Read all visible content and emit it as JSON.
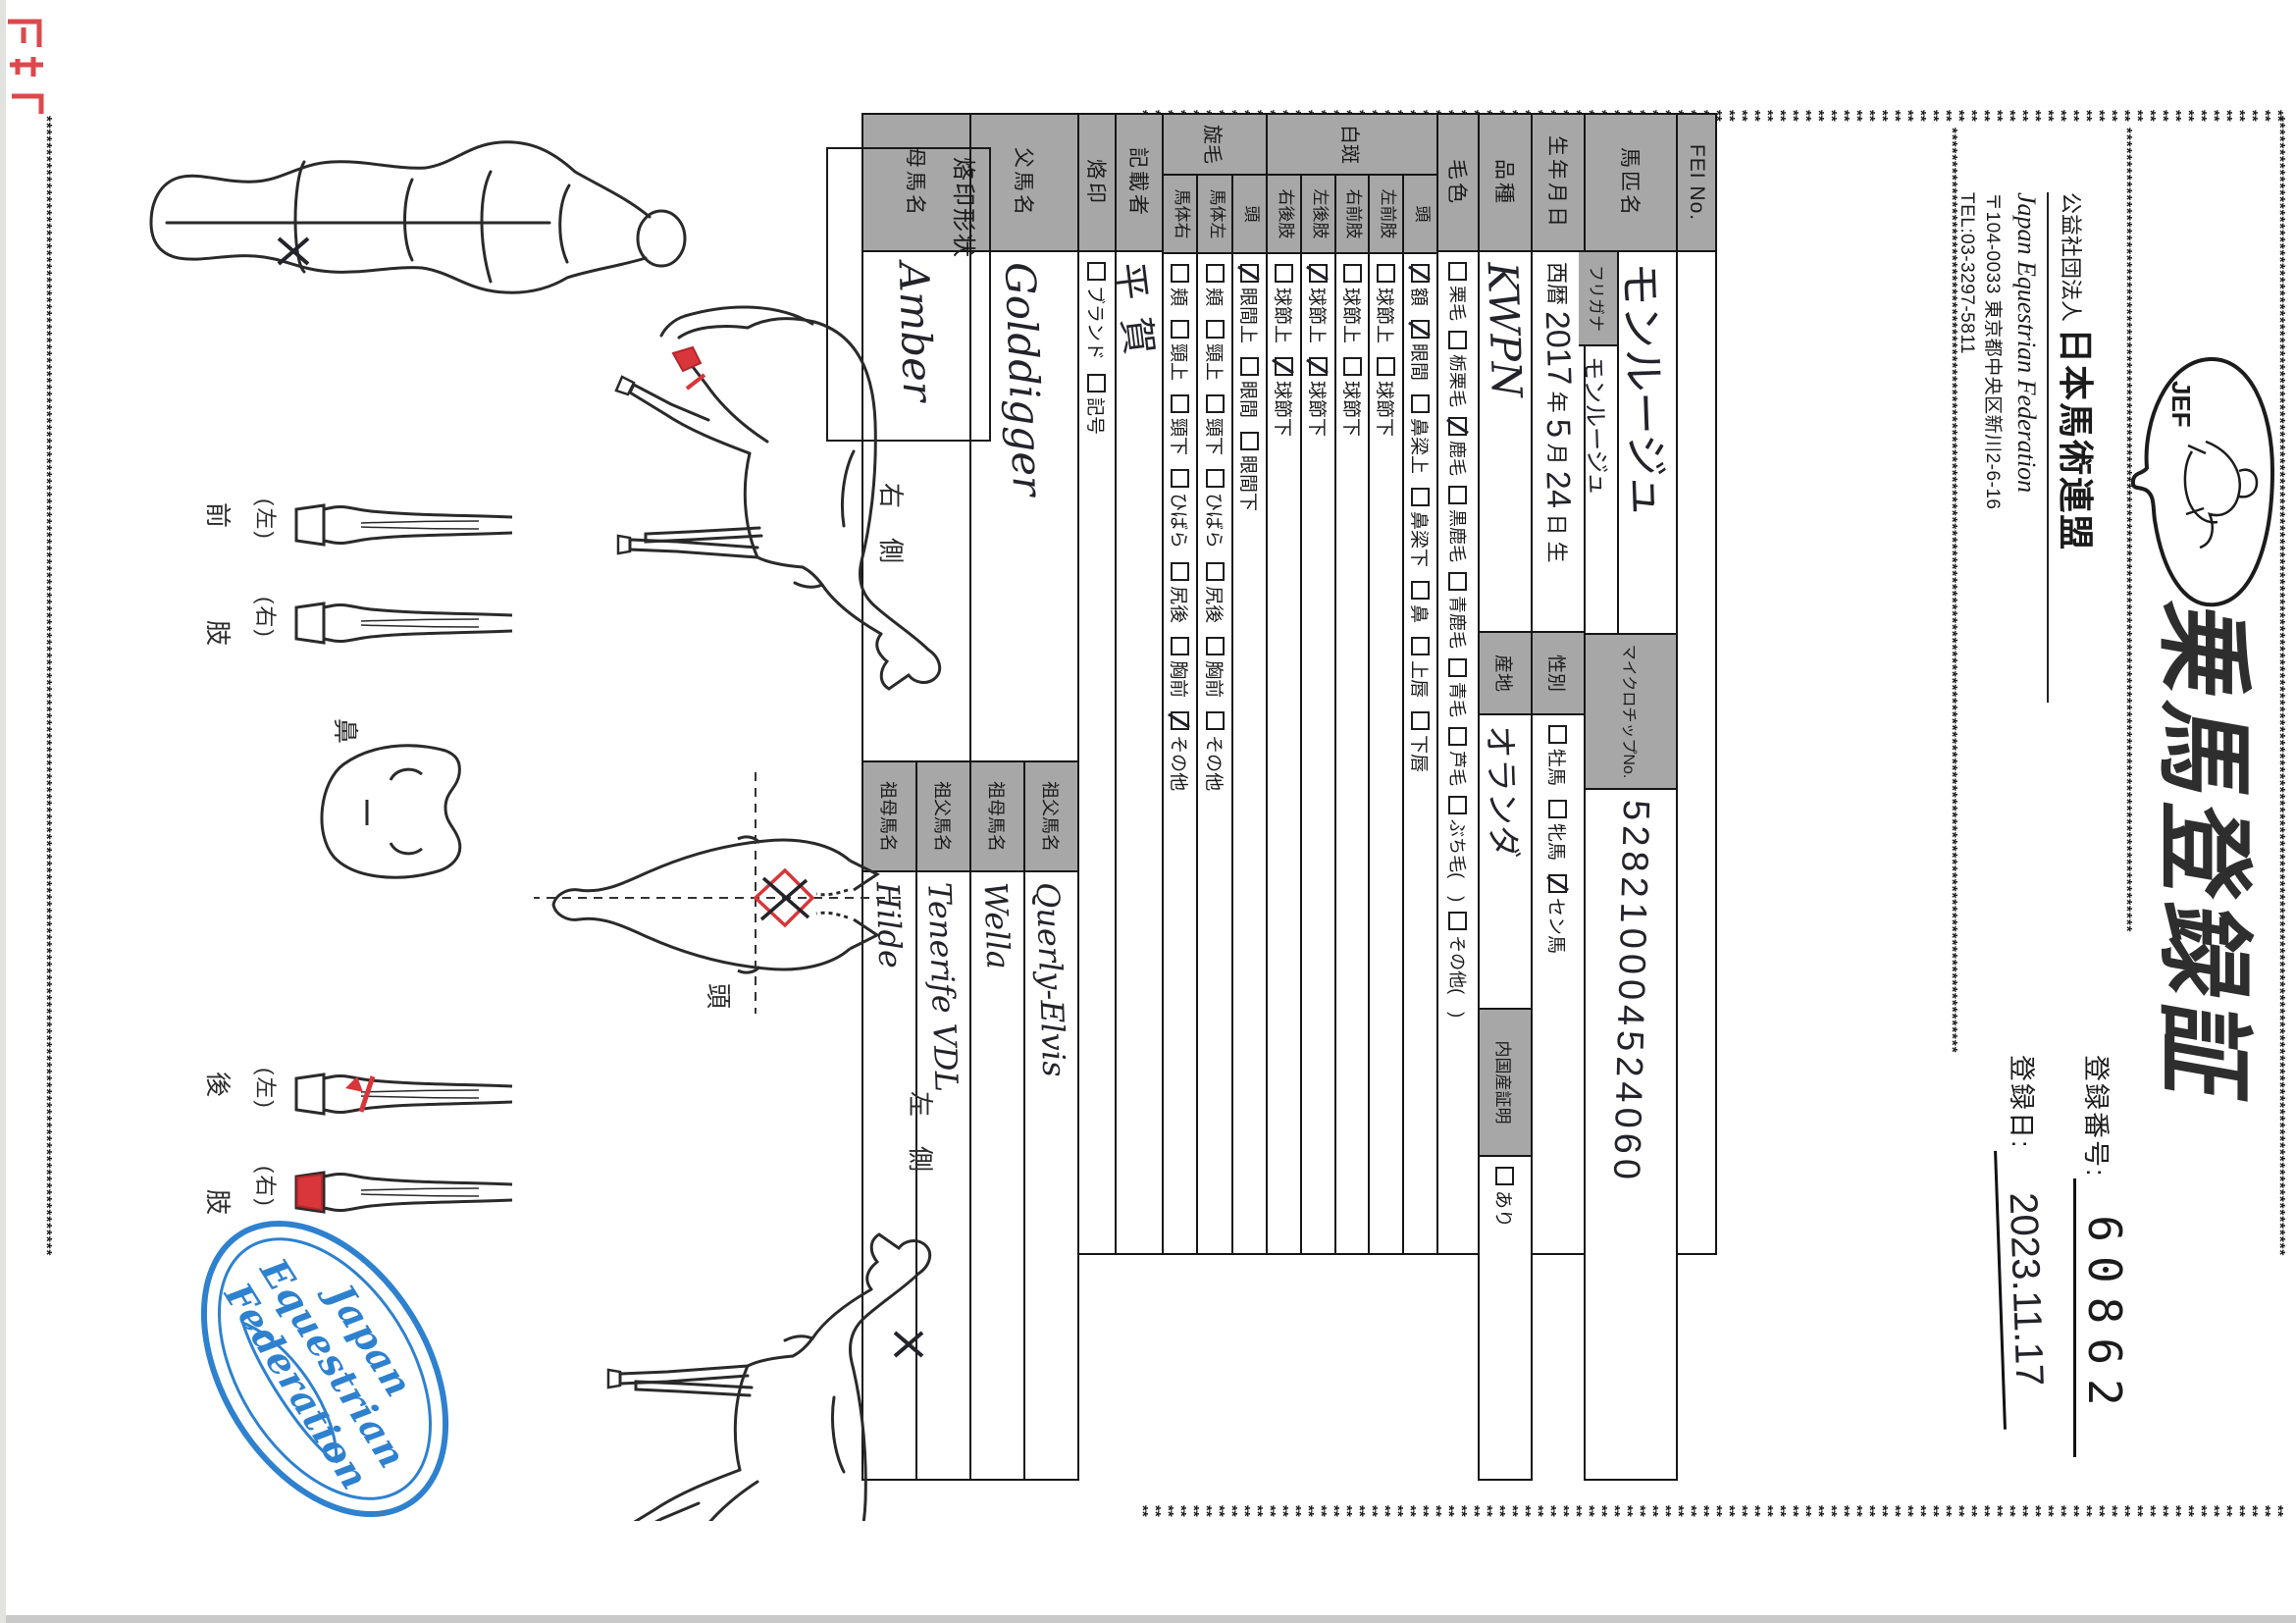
{
  "decor": {
    "star": "*",
    "ink": "#1b1b1b",
    "gray_cell": "#a7a7a7",
    "red": "#d8363a",
    "blue": "#2e81cf"
  },
  "header": {
    "logo_text": "JEF",
    "org_prefix": "公益社団法人",
    "org_name": "日本馬術連盟",
    "org_name_en": "Japan Equestrian Federation",
    "address": "〒104-0033 東京都中央区新川2-6-16",
    "tel": "TEL:03-3297-5811",
    "title": "乗馬登録証",
    "reg_no_label": "登録番号:",
    "reg_no": "60862",
    "reg_date_label": "登録日:",
    "reg_date": "2023.11.17"
  },
  "table": {
    "fei": {
      "label": "FEI No.",
      "value": ""
    },
    "name": {
      "label": "馬匹名",
      "value": "モンルージュ"
    },
    "furigana": {
      "label": "フリガナ",
      "value": "モンルージュ"
    },
    "microchip": {
      "label": "マイクロチップNo.",
      "value": "528210004524060"
    },
    "birth": {
      "label": "生年月日",
      "era": "西暦",
      "year": "2017",
      "year_suffix": "年",
      "month": "5",
      "month_suffix": "月",
      "day": "24",
      "day_suffix": "日 生"
    },
    "sex": {
      "label": "性別",
      "options": [
        {
          "label": "牡馬",
          "checked": false
        },
        {
          "label": "牝馬",
          "checked": false
        },
        {
          "label": "セン馬",
          "checked": true
        }
      ]
    },
    "breed": {
      "label": "品種",
      "value": "KWPN"
    },
    "origin": {
      "label": "産地",
      "value": "オランダ"
    },
    "domestic": {
      "label": "内国産証明",
      "options": [
        {
          "label": "あり",
          "checked": false
        }
      ]
    },
    "coat": {
      "label": "毛色",
      "options": [
        {
          "label": "栗毛",
          "checked": false
        },
        {
          "label": "栃栗毛",
          "checked": false
        },
        {
          "label": "鹿毛",
          "checked": true
        },
        {
          "label": "黒鹿毛",
          "checked": false
        },
        {
          "label": "青鹿毛",
          "checked": false
        },
        {
          "label": "青毛",
          "checked": false
        },
        {
          "label": "芦毛",
          "checked": false
        },
        {
          "label": "ぶち毛(　)",
          "checked": false
        },
        {
          "label": "その他(　)",
          "checked": false
        }
      ]
    },
    "hakuhan": {
      "group": "白斑",
      "rows": [
        {
          "label": "頭",
          "options": [
            {
              "label": "額",
              "checked": true
            },
            {
              "label": "眼間",
              "checked": true
            },
            {
              "label": "鼻梁上",
              "checked": false
            },
            {
              "label": "鼻梁下",
              "checked": false
            },
            {
              "label": "鼻",
              "checked": false
            },
            {
              "label": "上唇",
              "checked": false
            },
            {
              "label": "下唇",
              "checked": false
            }
          ]
        },
        {
          "label": "左前肢",
          "options": [
            {
              "label": "球節上",
              "checked": false
            },
            {
              "label": "球節下",
              "checked": false
            }
          ]
        },
        {
          "label": "右前肢",
          "options": [
            {
              "label": "球節上",
              "checked": false
            },
            {
              "label": "球節下",
              "checked": false
            }
          ]
        },
        {
          "label": "左後肢",
          "options": [
            {
              "label": "球節上",
              "checked": true
            },
            {
              "label": "球節下",
              "checked": true
            }
          ]
        },
        {
          "label": "右後肢",
          "options": [
            {
              "label": "球節上",
              "checked": false
            },
            {
              "label": "球節下",
              "checked": true
            }
          ]
        }
      ]
    },
    "senmou": {
      "group": "旋毛",
      "rows": [
        {
          "label": "頭",
          "options": [
            {
              "label": "眼間上",
              "checked": true
            },
            {
              "label": "眼間",
              "checked": false
            },
            {
              "label": "眼間下",
              "checked": false
            }
          ]
        },
        {
          "label": "馬体左",
          "options": [
            {
              "label": "頬",
              "checked": false
            },
            {
              "label": "頸上",
              "checked": false
            },
            {
              "label": "頸下",
              "checked": false
            },
            {
              "label": "ひばら",
              "checked": false
            },
            {
              "label": "尻後",
              "checked": false
            },
            {
              "label": "胸前",
              "checked": false
            },
            {
              "label": "その他",
              "checked": false
            }
          ]
        },
        {
          "label": "馬体右",
          "options": [
            {
              "label": "頬",
              "checked": false
            },
            {
              "label": "頸上",
              "checked": false
            },
            {
              "label": "頸下",
              "checked": false
            },
            {
              "label": "ひばら",
              "checked": false
            },
            {
              "label": "尻後",
              "checked": false
            },
            {
              "label": "胸前",
              "checked": false
            },
            {
              "label": "その他",
              "checked": true
            }
          ]
        }
      ]
    },
    "recorder": {
      "label": "記載者",
      "value": "平賀"
    },
    "brand": {
      "label": "烙印",
      "options": [
        {
          "label": "ブランド",
          "checked": false
        },
        {
          "label": "記号",
          "checked": false
        }
      ]
    },
    "sire": {
      "label": "父馬名",
      "value": "Golddigger",
      "gs_label": "祖父馬名",
      "gs": "Querly-Elvis",
      "gd_label": "祖母馬名",
      "gd": "Wella"
    },
    "dam": {
      "label": "母馬名",
      "value": "Amber",
      "gs_label": "祖父馬名",
      "gs": "Tenerife VDL",
      "gd_label": "祖母馬名",
      "gd": "Hilde"
    }
  },
  "diagram": {
    "brand_box_label": "烙印形状",
    "right_side_label": "右　側",
    "left_side_label": "左　側",
    "head_label": "頭",
    "nose_label": "鼻",
    "forelimb_label": "前　肢",
    "hindlimb_label": "後　肢",
    "left_label": "(左)",
    "right_label": "(右)",
    "stamp_line1": "Japan",
    "stamp_line2": "Equestrian",
    "stamp_line3": "Federation"
  }
}
